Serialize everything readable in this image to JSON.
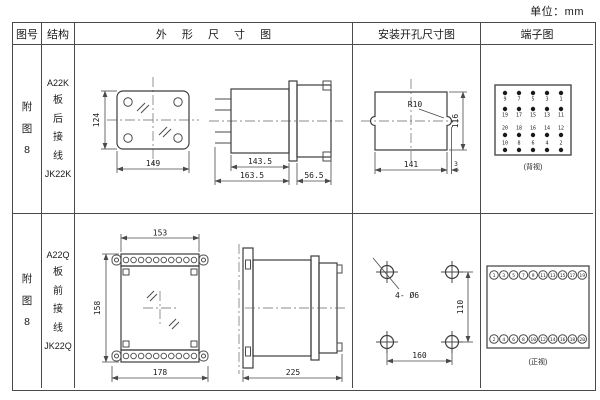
{
  "unit_label": "单位：mm",
  "colors": {
    "line": "#4a4a4a",
    "text": "#1a1a1a",
    "background": "#ffffff"
  },
  "header": {
    "col_figure": "图号",
    "col_structure": "结构",
    "col_outline": "外 形 尺 寸 图",
    "col_mounting": "安装开孔尺寸图",
    "col_terminal": "端子图"
  },
  "rows": [
    {
      "figure": [
        "附",
        "图",
        "8"
      ],
      "structure": [
        "A22K",
        "板",
        "后",
        "接",
        "线",
        "JK22K"
      ],
      "outline": {
        "front": {
          "height": "124",
          "width": "149"
        },
        "side": {
          "body": "143.5",
          "total": "163.5",
          "rear": "56.5"
        }
      },
      "mounting": {
        "radius": "R10",
        "width": "141",
        "height": "116",
        "offset": "3"
      },
      "terminal": {
        "caption": "(背视)",
        "grid": [
          [
            "9",
            "7",
            "5",
            "3",
            "1"
          ],
          [
            "19",
            "17",
            "15",
            "13",
            "11"
          ],
          [
            "20",
            "18",
            "16",
            "14",
            "12"
          ],
          [
            "10",
            "8",
            "6",
            "4",
            "2"
          ]
        ]
      }
    },
    {
      "figure": [
        "附",
        "图",
        "8"
      ],
      "structure": [
        "A22Q",
        "板",
        "前",
        "接",
        "线",
        "JK22Q"
      ],
      "outline": {
        "front": {
          "top": "153",
          "height": "158",
          "width": "178"
        },
        "side": {
          "length": "225"
        }
      },
      "mounting": {
        "holes": "4- Ø6",
        "width": "160",
        "height": "110"
      },
      "terminal": {
        "caption": "(正视)",
        "top": [
          "1",
          "3",
          "5",
          "7",
          "9",
          "11",
          "13",
          "15",
          "17",
          "19"
        ],
        "bottom": [
          "2",
          "4",
          "6",
          "8",
          "10",
          "12",
          "14",
          "16",
          "18",
          "20"
        ]
      }
    }
  ]
}
